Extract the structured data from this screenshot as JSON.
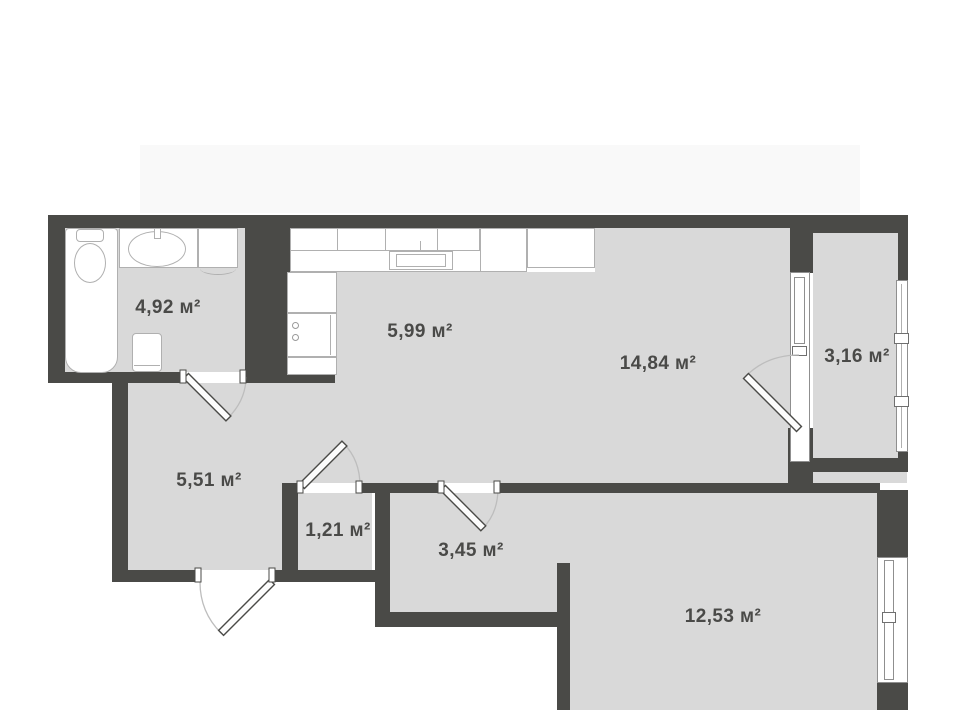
{
  "plan": {
    "title": "apartment-floor-plan",
    "unit": "м²",
    "rooms": [
      {
        "name": "bathroom",
        "area": "4,92",
        "area_label": "4,92 м²"
      },
      {
        "name": "kitchen",
        "area": "5,99",
        "area_label": "5,99 м²"
      },
      {
        "name": "living-room",
        "area": "14,84",
        "area_label": "14,84 м²"
      },
      {
        "name": "balcony",
        "area": "3,16",
        "area_label": "3,16 м²"
      },
      {
        "name": "hallway",
        "area": "5,51",
        "area_label": "5,51 м²"
      },
      {
        "name": "closet",
        "area": "1,21",
        "area_label": "1,21 м²"
      },
      {
        "name": "corridor",
        "area": "3,45",
        "area_label": "3,45 м²"
      },
      {
        "name": "bedroom",
        "area": "12,53",
        "area_label": "12,53 м²"
      }
    ],
    "fixtures": [
      "bathtub",
      "toilet",
      "wash-basin",
      "bathroom-cabinet",
      "washing-machine",
      "kitchen-upper-cabinets",
      "kitchen-counter",
      "kitchen-sink",
      "stove",
      "tall-unit"
    ],
    "openings": {
      "doors": [
        "bathroom-door",
        "entry-door",
        "closet-door",
        "corridor-door",
        "balcony-door"
      ],
      "windows": [
        "balcony-door-window",
        "balcony-side-window",
        "bedroom-window"
      ]
    },
    "colors": {
      "wall": "#4a4a47",
      "floor": "#d9d9d9",
      "fixture_fill": "#ffffff",
      "fixture_border": "#b0b0b0",
      "label_text": "#4a4a48",
      "door_arc": "#bdbdbd",
      "background": "#ffffff"
    }
  }
}
